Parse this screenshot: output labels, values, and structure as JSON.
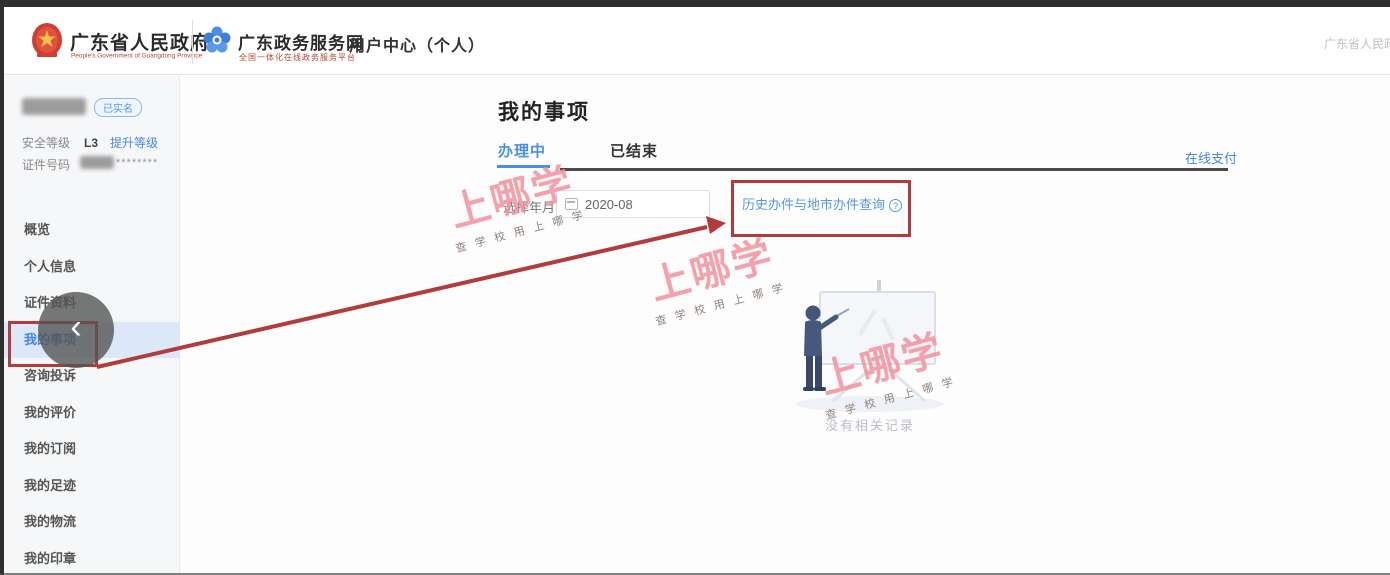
{
  "header": {
    "gov_logo_title": "广东省人民政府",
    "gov_logo_subtitle": "People's Government of Guangdong Province",
    "service_logo_title": "广东政务服务网",
    "service_logo_subtitle": "全国一体化在线政务服务平台",
    "center_label": "用户中心（个人）",
    "right_text": "广东省人民政"
  },
  "sidebar": {
    "user": {
      "verified_badge": "已实名",
      "security_label": "安全等级",
      "security_level": "L3",
      "upgrade_link": "提升等级",
      "id_label": "证件号码",
      "id_masked": "********"
    },
    "items": [
      {
        "label": "概览",
        "active": false
      },
      {
        "label": "个人信息",
        "active": false
      },
      {
        "label": "证件资料",
        "active": false
      },
      {
        "label": "我的事项",
        "active": true
      },
      {
        "label": "咨询投诉",
        "active": false
      },
      {
        "label": "我的评价",
        "active": false
      },
      {
        "label": "我的订阅",
        "active": false
      },
      {
        "label": "我的足迹",
        "active": false
      },
      {
        "label": "我的物流",
        "active": false
      },
      {
        "label": "我的印章",
        "active": false
      }
    ],
    "collapse_icon": "‹"
  },
  "main": {
    "title": "我的事项",
    "tabs": [
      {
        "label": "办理中",
        "active": true
      },
      {
        "label": "已结束",
        "active": false
      }
    ],
    "pay_link": "在线支付",
    "filter": {
      "label": "选择年月:",
      "value": "2020-08"
    },
    "history_link": "历史办件与地市办件查询",
    "help_icon": "?",
    "empty_text": "没有相关记录"
  },
  "watermark": {
    "big": "上哪学",
    "small": "查 学 校  用 上 哪 学"
  },
  "colors": {
    "accent_blue": "#4a86e0",
    "active_tab_blue": "#4a90e2",
    "annotation_red": "#b23b3b",
    "watermark_pink": "#f4919f",
    "header_subtitle_red": "#b8432f"
  }
}
